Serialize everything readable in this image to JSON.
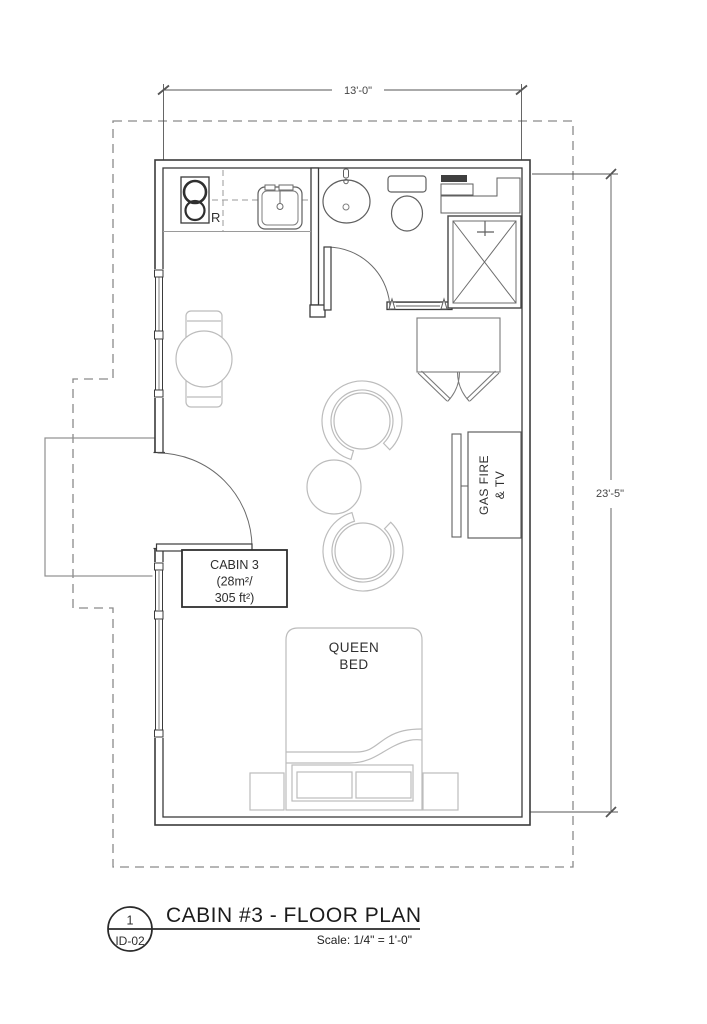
{
  "plan": {
    "dim_width": "13'-0\"",
    "dim_height": "23'-5\"",
    "room_label": {
      "line1": "CABIN 3",
      "line2": "(28m²/",
      "line3": "305 ft²)"
    },
    "bed_label": {
      "line1": "QUEEN",
      "line2": "BED"
    },
    "fireplace_label": {
      "line1": "GAS FIRE",
      "line2": "& TV"
    },
    "refrigerator_label": "R"
  },
  "title_block": {
    "detail_number": "1",
    "sheet_id": "ID-02",
    "title": "CABIN #3 - FLOOR PLAN",
    "scale": "Scale: 1/4\" = 1'-0\""
  },
  "colors": {
    "wall": "#3b3b3b",
    "fixture": "#5f5f5f",
    "furniture": "#bcbcbc",
    "boundary": "#8a8a8a",
    "dimension": "#555555",
    "text": "#2f2f2f",
    "background": "#ffffff"
  }
}
